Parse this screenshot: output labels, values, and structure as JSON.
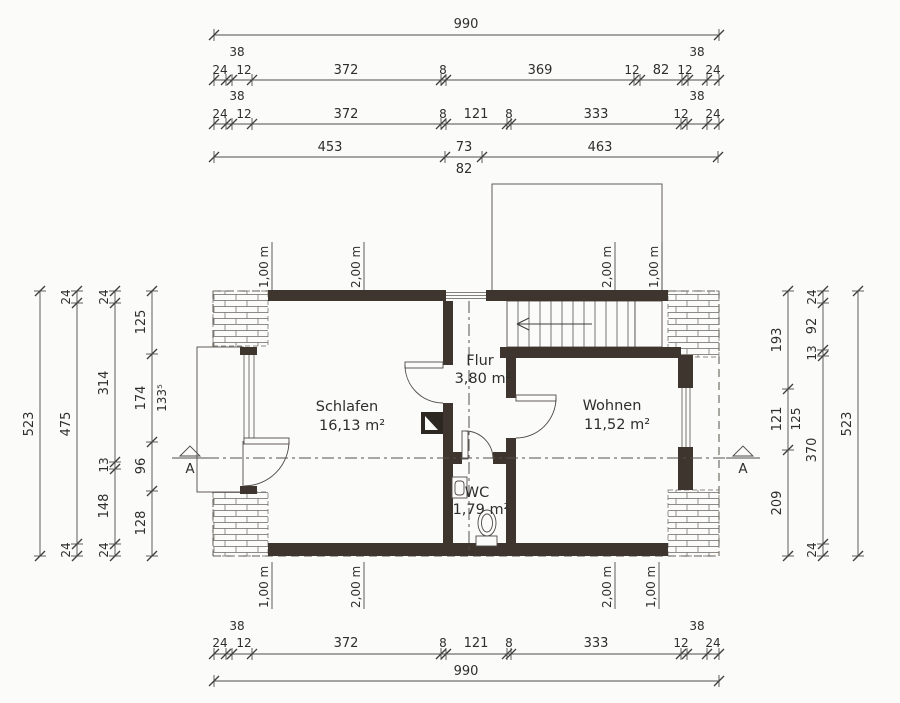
{
  "rooms": {
    "schlafen": {
      "name": "Schlafen",
      "area": "16,13 m²"
    },
    "wohnen": {
      "name": "Wohnen",
      "area": "11,52 m²"
    },
    "flur": {
      "name": "Flur",
      "area": "3,80 m²"
    },
    "wc": {
      "name": "WC",
      "area": "1,79 m²"
    }
  },
  "section_marker": "A",
  "heights": {
    "one": "1,00 m",
    "two": "2,00 m"
  },
  "dims": {
    "top": {
      "total": "990",
      "row2": [
        "24",
        "12",
        "38",
        "372",
        "8",
        "369",
        "12",
        "82",
        "12",
        "38",
        "24"
      ],
      "row3": [
        "24",
        "12",
        "38",
        "372",
        "8",
        "121",
        "8",
        "333",
        "12",
        "38",
        "24"
      ],
      "row4": [
        "453",
        "73",
        "82",
        "463"
      ]
    },
    "left": {
      "total": "523",
      "chain2": [
        "24",
        "475",
        "24"
      ],
      "chain3": [
        "24",
        "314",
        "13",
        "148",
        "24"
      ],
      "chain4": [
        "125",
        "174",
        "133⁵",
        "96",
        "128"
      ]
    },
    "right": {
      "chain1": [
        "193",
        "121",
        "125",
        "209"
      ],
      "chain2": [
        "24",
        "92",
        "13",
        "370",
        "24"
      ],
      "total": "523"
    },
    "bottom": {
      "row1": [
        "24",
        "12",
        "38",
        "372",
        "8",
        "121",
        "8",
        "333",
        "12",
        "38",
        "24"
      ],
      "total": "990"
    }
  },
  "colors": {
    "wall": "#3d352e",
    "line": "#4c4c4c",
    "paper": "#fbfbf9"
  }
}
